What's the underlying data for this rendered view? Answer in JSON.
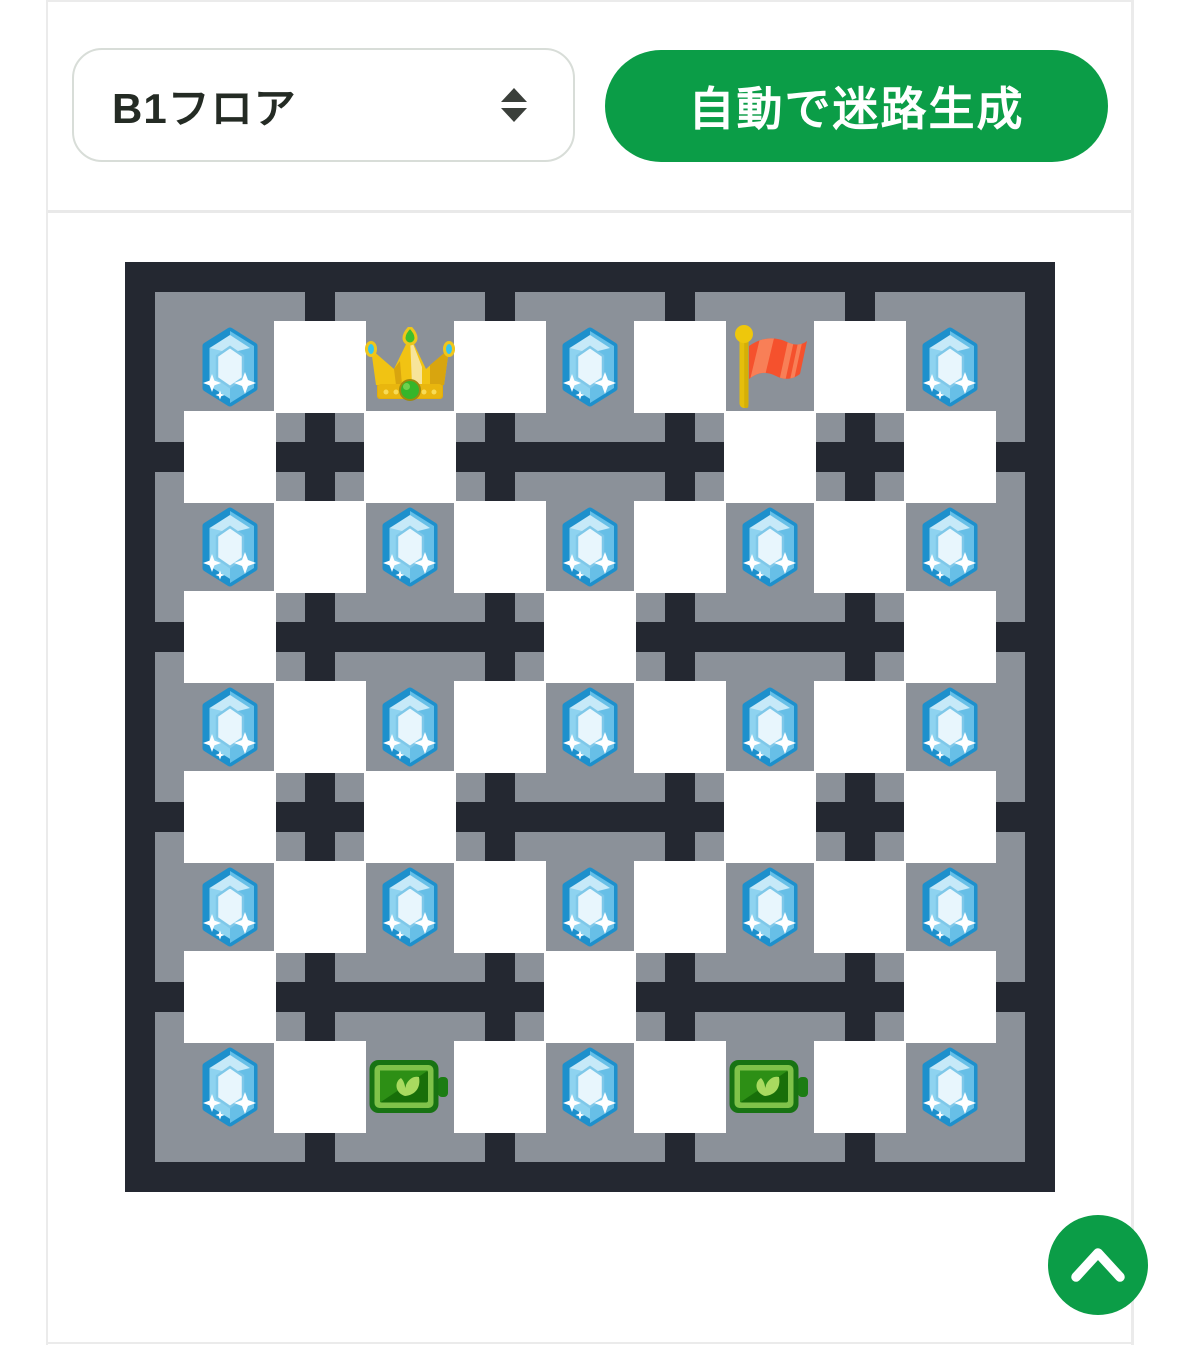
{
  "page": {
    "background": "#ffffff",
    "frame_border_color": "#ebebeb",
    "divider_color": "#e9e9e9"
  },
  "toolbar": {
    "floor_select": {
      "value": "B1フロア",
      "border_color": "#d8ddd8",
      "arrow_icon": "up-down-arrows",
      "arrow_color": "#3a3f3a"
    },
    "generate_button": {
      "label": "自動で迷路生成",
      "background": "#0b9d47",
      "text_color": "#ffffff"
    }
  },
  "maze": {
    "rows": 5,
    "cols": 5,
    "wall_color": "#242831",
    "floor_color": "#8b9199",
    "open_color": "#ffffff",
    "rooms": [
      [
        "gem",
        "crown",
        "gem",
        "flag",
        "gem"
      ],
      [
        "gem",
        "gem",
        "gem",
        "gem",
        "gem"
      ],
      [
        "gem",
        "gem",
        "gem",
        "gem",
        "gem"
      ],
      [
        "gem",
        "gem",
        "gem",
        "gem",
        "gem"
      ],
      [
        "gem",
        "battery",
        "gem",
        "battery",
        "gem"
      ]
    ],
    "h_open": [
      [
        1,
        1,
        1,
        1
      ],
      [
        1,
        1,
        1,
        1
      ],
      [
        1,
        1,
        1,
        1
      ],
      [
        1,
        1,
        1,
        1
      ],
      [
        1,
        1,
        1,
        1
      ]
    ],
    "v_open": [
      [
        1,
        1,
        0,
        1,
        1
      ],
      [
        1,
        0,
        1,
        0,
        1
      ],
      [
        1,
        1,
        0,
        1,
        1
      ],
      [
        1,
        0,
        1,
        0,
        1
      ]
    ],
    "item_colors": {
      "gem_border": "#1d90cc",
      "gem_body": "#8ed3f0",
      "crown_gold": "#f1c313",
      "flag_red": "#f5512d",
      "battery_green": "#7fc24a"
    }
  },
  "fab": {
    "icon": "chevron-up",
    "background": "#0b9d47",
    "icon_color": "#ffffff"
  }
}
